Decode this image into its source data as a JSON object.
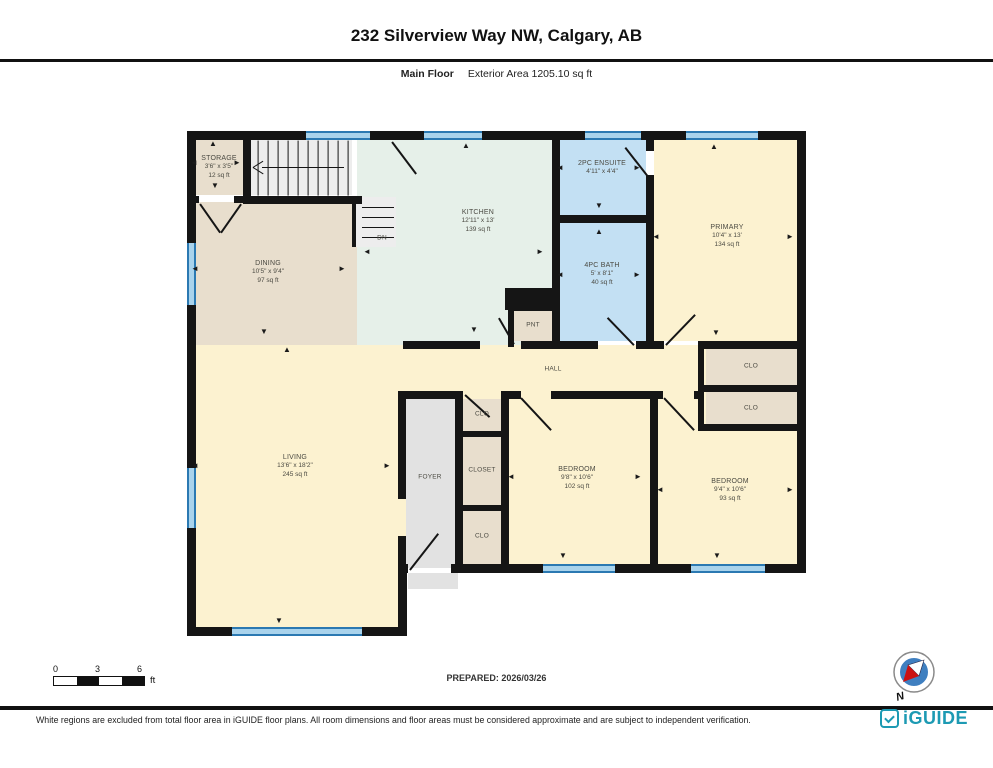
{
  "title": "232 Silverview Way NW, Calgary, AB",
  "subtitle": {
    "floor": "Main Floor",
    "area": "Exterior Area 1205.10 sq ft"
  },
  "prepared": "PREPARED: 2026/03/26",
  "scale_bar": {
    "labels": [
      "0",
      "3",
      "6"
    ],
    "unit": "ft"
  },
  "compass": {
    "label": "N"
  },
  "footer": {
    "disclaimer": "White regions are excluded from total floor area in iGUIDE floor plans. All room dimensions and floor areas must be considered approximate and are subject to independent verification.",
    "brand": "iGUIDE"
  },
  "colors": {
    "tan": "#e8decd",
    "mint": "#e6f0e9",
    "blue": "#c3e0f3",
    "yellow": "#fcf2d0",
    "gray": "#e2e2e2",
    "stair": "#ededed",
    "black": "#151515",
    "wall": "#151515",
    "window_fill": "#a9d3ec",
    "window_edge": "#2b79b2",
    "brand_teal": "#1d9ab3",
    "compass_blue": "#3f7fc0",
    "compass_red": "#cc1111"
  },
  "plan": {
    "underlays": [
      {
        "x": 193,
        "y": 345,
        "w": 609,
        "h": 223,
        "c": "yellow"
      },
      {
        "x": 193,
        "y": 345,
        "w": 205,
        "h": 287,
        "c": "yellow"
      }
    ],
    "rooms": [
      {
        "name": "STORAGE",
        "dims": "3'6\" x 3'5\"",
        "area": "12 sq ft",
        "rect": {
          "x": 193,
          "y": 139,
          "w": 50,
          "h": 56
        },
        "c": "tan",
        "cx": 219,
        "cy": 167
      },
      {
        "name": "DINING",
        "dims": "10'5\" x 9'4\"",
        "area": "97 sq ft",
        "rect": {
          "x": 193,
          "y": 202,
          "w": 164,
          "h": 143
        },
        "c": "tan",
        "cx": 268,
        "cy": 272
      },
      {
        "name": "KITCHEN",
        "dims": "12'11\" x 13'",
        "area": "139 sq ft",
        "rect": {
          "x": 357,
          "y": 139,
          "w": 195,
          "h": 206
        },
        "c": "mint",
        "cx": 478,
        "cy": 221
      },
      {
        "name": "2PC ENSUITE",
        "dims": "4'11\" x 4'4\"",
        "area": "",
        "rect": {
          "x": 560,
          "y": 139,
          "w": 86,
          "h": 76
        },
        "c": "blue",
        "cx": 602,
        "cy": 168
      },
      {
        "name": "4PC BATH",
        "dims": "5' x 8'1\"",
        "area": "40 sq ft",
        "rect": {
          "x": 560,
          "y": 223,
          "w": 86,
          "h": 118
        },
        "c": "blue",
        "cx": 602,
        "cy": 274
      },
      {
        "name": "PRIMARY",
        "dims": "10'4\" x 13'",
        "area": "134 sq ft",
        "rect": {
          "x": 654,
          "y": 139,
          "w": 143,
          "h": 202
        },
        "c": "yellow",
        "cx": 727,
        "cy": 236
      },
      {
        "name": "LIVING",
        "dims": "13'6\" x 18'2\"",
        "area": "245 sq ft",
        "rect": null,
        "c": "yellow",
        "cx": 295,
        "cy": 466
      },
      {
        "name": "BEDROOM",
        "dims": "9'8\" x 10'6\"",
        "area": "102 sq ft",
        "rect": null,
        "c": "yellow",
        "cx": 577,
        "cy": 478
      },
      {
        "name": "BEDROOM",
        "dims": "9'4\" x 10'6\"",
        "area": "93 sq ft",
        "rect": null,
        "c": "yellow",
        "cx": 730,
        "cy": 490
      }
    ],
    "overlays": [
      {
        "x": 406,
        "y": 395,
        "w": 49,
        "h": 173,
        "c": "gray"
      },
      {
        "x": 463,
        "y": 399,
        "w": 38,
        "h": 32,
        "c": "tan"
      },
      {
        "x": 463,
        "y": 437,
        "w": 38,
        "h": 68,
        "c": "tan"
      },
      {
        "x": 463,
        "y": 511,
        "w": 38,
        "h": 53,
        "c": "tan"
      },
      {
        "x": 706,
        "y": 349,
        "w": 91,
        "h": 36,
        "c": "tan"
      },
      {
        "x": 706,
        "y": 392,
        "w": 91,
        "h": 32,
        "c": "tan"
      },
      {
        "x": 514,
        "y": 309,
        "w": 38,
        "h": 32,
        "c": "tan"
      },
      {
        "x": 505,
        "y": 288,
        "w": 48,
        "h": 22,
        "c": "black"
      },
      {
        "x": 247,
        "y": 139,
        "w": 105,
        "h": 56,
        "c": "stair"
      },
      {
        "x": 352,
        "y": 197,
        "w": 44,
        "h": 50,
        "c": "stair"
      },
      {
        "x": 408,
        "y": 573,
        "w": 50,
        "h": 16,
        "c": "gray"
      }
    ],
    "annotations": [
      {
        "t": "HALL",
        "x": 553,
        "y": 369
      },
      {
        "t": "FOYER",
        "x": 430,
        "y": 477
      },
      {
        "t": "CLOSET",
        "x": 482,
        "y": 470
      },
      {
        "t": "CLO",
        "x": 482,
        "y": 414
      },
      {
        "t": "CLO",
        "x": 482,
        "y": 536
      },
      {
        "t": "CLO",
        "x": 751,
        "y": 366
      },
      {
        "t": "CLO",
        "x": 751,
        "y": 408
      },
      {
        "t": "PNT",
        "x": 533,
        "y": 325
      },
      {
        "t": "DN",
        "x": 382,
        "y": 238
      }
    ],
    "walls": [
      {
        "x": 187,
        "y": 131,
        "w": 619,
        "h": 9
      },
      {
        "x": 187,
        "y": 131,
        "w": 9,
        "h": 505
      },
      {
        "x": 797,
        "y": 131,
        "w": 9,
        "h": 441
      },
      {
        "x": 398,
        "y": 564,
        "w": 10,
        "h": 9
      },
      {
        "x": 451,
        "y": 564,
        "w": 355,
        "h": 9
      },
      {
        "x": 187,
        "y": 627,
        "w": 220,
        "h": 9
      },
      {
        "x": 398,
        "y": 564,
        "w": 9,
        "h": 72
      },
      {
        "x": 243,
        "y": 139,
        "w": 8,
        "h": 64
      },
      {
        "x": 187,
        "y": 196,
        "w": 12,
        "h": 7
      },
      {
        "x": 234,
        "y": 196,
        "w": 17,
        "h": 7
      },
      {
        "x": 243,
        "y": 196,
        "w": 119,
        "h": 8
      },
      {
        "x": 552,
        "y": 139,
        "w": 8,
        "h": 210
      },
      {
        "x": 552,
        "y": 215,
        "w": 94,
        "h": 8
      },
      {
        "x": 646,
        "y": 139,
        "w": 8,
        "h": 12
      },
      {
        "x": 646,
        "y": 175,
        "w": 8,
        "h": 48
      },
      {
        "x": 646,
        "y": 223,
        "w": 8,
        "h": 126
      },
      {
        "x": 403,
        "y": 341,
        "w": 77,
        "h": 8
      },
      {
        "x": 521,
        "y": 341,
        "w": 31,
        "h": 8
      },
      {
        "x": 552,
        "y": 341,
        "w": 46,
        "h": 8
      },
      {
        "x": 636,
        "y": 341,
        "w": 10,
        "h": 8
      },
      {
        "x": 646,
        "y": 341,
        "w": 18,
        "h": 8
      },
      {
        "x": 698,
        "y": 341,
        "w": 108,
        "h": 8
      },
      {
        "x": 698,
        "y": 385,
        "w": 108,
        "h": 7
      },
      {
        "x": 698,
        "y": 424,
        "w": 108,
        "h": 7
      },
      {
        "x": 698,
        "y": 349,
        "w": 6,
        "h": 80
      },
      {
        "x": 398,
        "y": 391,
        "w": 65,
        "h": 8
      },
      {
        "x": 455,
        "y": 391,
        "w": 8,
        "h": 177
      },
      {
        "x": 501,
        "y": 391,
        "w": 8,
        "h": 177
      },
      {
        "x": 463,
        "y": 431,
        "w": 38,
        "h": 6
      },
      {
        "x": 463,
        "y": 505,
        "w": 38,
        "h": 6
      },
      {
        "x": 509,
        "y": 391,
        "w": 12,
        "h": 8
      },
      {
        "x": 551,
        "y": 391,
        "w": 99,
        "h": 8
      },
      {
        "x": 650,
        "y": 391,
        "w": 8,
        "h": 173
      },
      {
        "x": 658,
        "y": 391,
        "w": 5,
        "h": 8
      },
      {
        "x": 694,
        "y": 391,
        "w": 4,
        "h": 8
      },
      {
        "x": 508,
        "y": 305,
        "w": 46,
        "h": 6
      },
      {
        "x": 508,
        "y": 305,
        "w": 6,
        "h": 42
      },
      {
        "x": 352,
        "y": 197,
        "w": 4,
        "h": 50
      },
      {
        "x": 398,
        "y": 399,
        "w": 8,
        "h": 100
      },
      {
        "x": 398,
        "y": 536,
        "w": 8,
        "h": 34
      }
    ],
    "windows": [
      {
        "x": 306,
        "y": 131,
        "w": 64,
        "h": 9,
        "o": "h"
      },
      {
        "x": 424,
        "y": 131,
        "w": 58,
        "h": 9,
        "o": "h"
      },
      {
        "x": 585,
        "y": 131,
        "w": 56,
        "h": 9,
        "o": "h"
      },
      {
        "x": 686,
        "y": 131,
        "w": 72,
        "h": 9,
        "o": "h"
      },
      {
        "x": 187,
        "y": 243,
        "w": 9,
        "h": 62,
        "o": "v"
      },
      {
        "x": 187,
        "y": 468,
        "w": 9,
        "h": 60,
        "o": "v"
      },
      {
        "x": 232,
        "y": 627,
        "w": 130,
        "h": 9,
        "o": "h"
      },
      {
        "x": 543,
        "y": 564,
        "w": 72,
        "h": 9,
        "o": "h"
      },
      {
        "x": 691,
        "y": 564,
        "w": 74,
        "h": 9,
        "o": "h"
      }
    ],
    "lines": [
      {
        "x": 410,
        "y": 569,
        "len": 46,
        "deg": -52
      },
      {
        "x": 200,
        "y": 203,
        "len": 35,
        "deg": 55
      },
      {
        "x": 241,
        "y": 203,
        "len": 35,
        "deg": 125
      },
      {
        "x": 392,
        "y": 141,
        "len": 40,
        "deg": 53
      },
      {
        "x": 650,
        "y": 178,
        "len": 40,
        "deg": -128
      },
      {
        "x": 634,
        "y": 344,
        "len": 38,
        "deg": -134
      },
      {
        "x": 666,
        "y": 344,
        "len": 42,
        "deg": -46
      },
      {
        "x": 521,
        "y": 397,
        "len": 44,
        "deg": 47
      },
      {
        "x": 664,
        "y": 397,
        "len": 44,
        "deg": 47
      },
      {
        "x": 465,
        "y": 394,
        "len": 33,
        "deg": 42
      },
      {
        "x": 514,
        "y": 343,
        "len": 30,
        "deg": -120
      },
      {
        "x": 262,
        "y": 167,
        "len": 82,
        "deg": 0,
        "t": 1.4
      },
      {
        "x": 253,
        "y": 167,
        "len": 12,
        "deg": -32,
        "t": 1.4
      },
      {
        "x": 253,
        "y": 167,
        "len": 12,
        "deg": 32,
        "t": 1.4
      },
      {
        "x": 258,
        "y": 140,
        "len": 55,
        "deg": 90,
        "t": 1.2
      },
      {
        "x": 268,
        "y": 140,
        "len": 55,
        "deg": 90,
        "t": 1.2
      },
      {
        "x": 278,
        "y": 140,
        "len": 55,
        "deg": 90,
        "t": 1.2
      },
      {
        "x": 288,
        "y": 140,
        "len": 55,
        "deg": 90,
        "t": 1.2
      },
      {
        "x": 298,
        "y": 140,
        "len": 55,
        "deg": 90,
        "t": 1.2
      },
      {
        "x": 308,
        "y": 140,
        "len": 55,
        "deg": 90,
        "t": 1.2
      },
      {
        "x": 318,
        "y": 140,
        "len": 55,
        "deg": 90,
        "t": 1.2
      },
      {
        "x": 328,
        "y": 140,
        "len": 55,
        "deg": 90,
        "t": 1.2
      },
      {
        "x": 338,
        "y": 140,
        "len": 55,
        "deg": 90,
        "t": 1.2
      },
      {
        "x": 348,
        "y": 140,
        "len": 55,
        "deg": 90,
        "t": 1.2
      },
      {
        "x": 362,
        "y": 207,
        "len": 32,
        "deg": 0,
        "t": 1.2
      },
      {
        "x": 362,
        "y": 217,
        "len": 32,
        "deg": 0,
        "t": 1.2
      },
      {
        "x": 362,
        "y": 227,
        "len": 32,
        "deg": 0,
        "t": 1.2
      },
      {
        "x": 362,
        "y": 237,
        "len": 32,
        "deg": 0,
        "t": 1.2
      }
    ],
    "arrows": [
      {
        "g": "▲",
        "x": 213,
        "y": 144
      },
      {
        "g": "◄",
        "x": 194,
        "y": 163
      },
      {
        "g": "►",
        "x": 237,
        "y": 163
      },
      {
        "g": "▼",
        "x": 215,
        "y": 186
      },
      {
        "g": "◄",
        "x": 195,
        "y": 269
      },
      {
        "g": "►",
        "x": 342,
        "y": 269
      },
      {
        "g": "▼",
        "x": 264,
        "y": 332
      },
      {
        "g": "▲",
        "x": 466,
        "y": 146
      },
      {
        "g": "►",
        "x": 540,
        "y": 252
      },
      {
        "g": "▼",
        "x": 474,
        "y": 330
      },
      {
        "g": "◄",
        "x": 367,
        "y": 252
      },
      {
        "g": "◄",
        "x": 560,
        "y": 168
      },
      {
        "g": "►",
        "x": 637,
        "y": 168
      },
      {
        "g": "▼",
        "x": 599,
        "y": 206
      },
      {
        "g": "▲",
        "x": 599,
        "y": 232
      },
      {
        "g": "◄",
        "x": 560,
        "y": 275
      },
      {
        "g": "►",
        "x": 637,
        "y": 275
      },
      {
        "g": "▲",
        "x": 714,
        "y": 147
      },
      {
        "g": "◄",
        "x": 656,
        "y": 237
      },
      {
        "g": "►",
        "x": 790,
        "y": 237
      },
      {
        "g": "▼",
        "x": 716,
        "y": 333
      },
      {
        "g": "▲",
        "x": 287,
        "y": 350
      },
      {
        "g": "◄",
        "x": 195,
        "y": 466
      },
      {
        "g": "►",
        "x": 387,
        "y": 466
      },
      {
        "g": "▼",
        "x": 279,
        "y": 621
      },
      {
        "g": "◄",
        "x": 511,
        "y": 477
      },
      {
        "g": "►",
        "x": 638,
        "y": 477
      },
      {
        "g": "▼",
        "x": 563,
        "y": 556
      },
      {
        "g": "◄",
        "x": 660,
        "y": 490
      },
      {
        "g": "►",
        "x": 790,
        "y": 490
      },
      {
        "g": "▼",
        "x": 717,
        "y": 556
      }
    ]
  }
}
